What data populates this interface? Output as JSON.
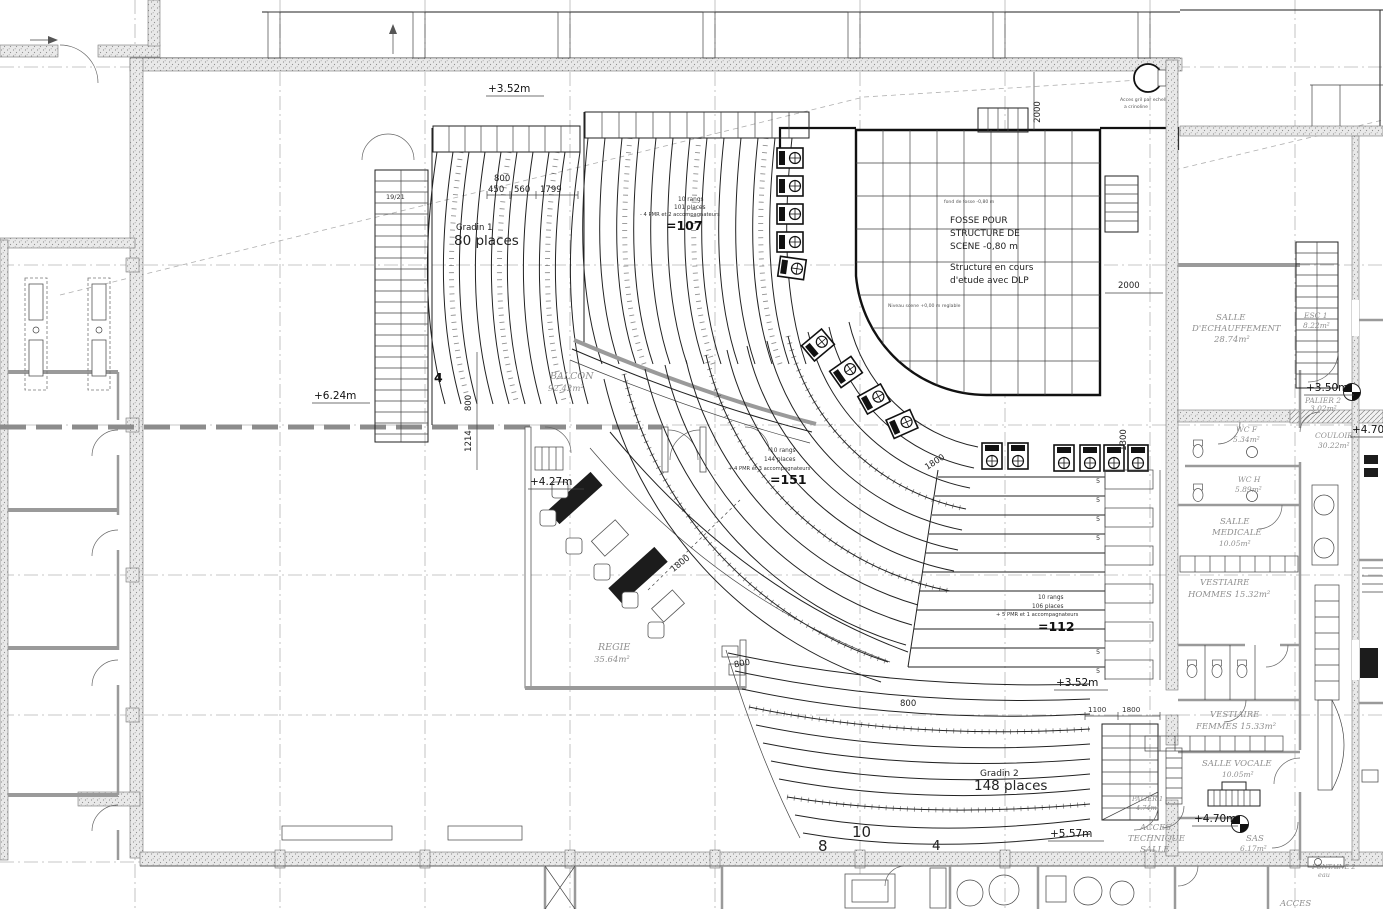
{
  "drawing": {
    "levels": {
      "hall_top": "+3.52m",
      "balcony": "+6.24m",
      "regie": "+4.27m",
      "palier2": "+3.50m",
      "couloir": "+4.70m",
      "vocale": "+4.70m",
      "gradin2": "+5.57m",
      "side_block": "+3.52m"
    },
    "seating": {
      "gradin1": {
        "name": "Gradin 1",
        "places": "80 places"
      },
      "balcony_block": {
        "rows": "10 rangs",
        "places": "101 places",
        "pmr": "- 4 PMR et 2 accompagnateurs",
        "total": "=107"
      },
      "parterre_block": {
        "rows": "10 rangs",
        "places": "144 places",
        "pmr": "+ 4 PMR et 3 accompagnateurs",
        "total": "=151"
      },
      "side_block": {
        "rows": "10 rangs",
        "places": "106 places",
        "pmr": "+ 5 PMR et 1 accompagnateurs",
        "total": "=112",
        "row_count": "5"
      },
      "gradin2": {
        "name": "Gradin 2",
        "places": "148 places"
      },
      "row_numbers": {
        "n8": "8",
        "n10": "10",
        "n4_bottom": "4",
        "n4_balcony": "4"
      }
    },
    "stage": {
      "fosse1": "FOSSE POUR",
      "fosse2": "STRUCTURE DE",
      "fosse3": "SCENE -0,80 m",
      "note1": "Structure en cours",
      "note2": "d'etude avec DLP",
      "fond_note": "fond de fosse -0,80 m",
      "niveau_note": "Niveau scene +0,00 m reglable",
      "gril1": "Acces gril par echelle",
      "gril2": "a crinoline"
    },
    "rooms": {
      "balcon": {
        "name": "BALCON",
        "area": "92.42m²"
      },
      "regie": {
        "name": "REGIE",
        "area": "35.64m²"
      },
      "echauffement": {
        "l1": "SALLE",
        "l2": "D'ECHAUFFEMENT",
        "area": "28.74m²"
      },
      "esc1": {
        "name": "ESC 1",
        "area": "8.22m²"
      },
      "palier2": {
        "name": "PALIER 2",
        "area": "3.02m²"
      },
      "wcf": {
        "name": "WC F",
        "area": "5.34m²"
      },
      "wch": {
        "name": "WC H",
        "area": "5.89m²"
      },
      "medicale": {
        "l1": "SALLE",
        "l2": "MEDICALE",
        "area": "10.05m²"
      },
      "vest_h": {
        "l1": "VESTIAIRE",
        "l2": "HOMMES 15.32m²"
      },
      "vest_f": {
        "l1": "VESTIAIRE",
        "l2": "FEMMES 15.33m²"
      },
      "vocale": {
        "name": "SALLE VOCALE",
        "area": "10.05m²"
      },
      "couloir": {
        "name": "COULOIR",
        "area": "30.22m²"
      },
      "sas": {
        "name": "SAS",
        "area": "6.17m²"
      },
      "palier1": {
        "name": "PALIER 1",
        "area": "4.74m²"
      },
      "acces_tech": {
        "l1": "ACCES",
        "l2": "TECHNIQUE",
        "l3": "SALLE"
      },
      "fontaine": {
        "name": "FONTAINE 2",
        "sub": "eau"
      },
      "acces": {
        "name": "ACCES"
      }
    },
    "dimensions": {
      "top_800": "800",
      "top_450": "450",
      "top_560": "560",
      "top_1799": "1799",
      "stage_2000_v": "2000",
      "stage_2000_h": "2000",
      "balc_800": "800",
      "balc_1214": "1214",
      "regie_1800": "1800",
      "mid_1800": "1800",
      "side_1300": "1300",
      "low_800a": "800",
      "low_800b": "800",
      "low_1100": "1100",
      "low_1800": "1800",
      "stair_count": "19/21"
    }
  }
}
